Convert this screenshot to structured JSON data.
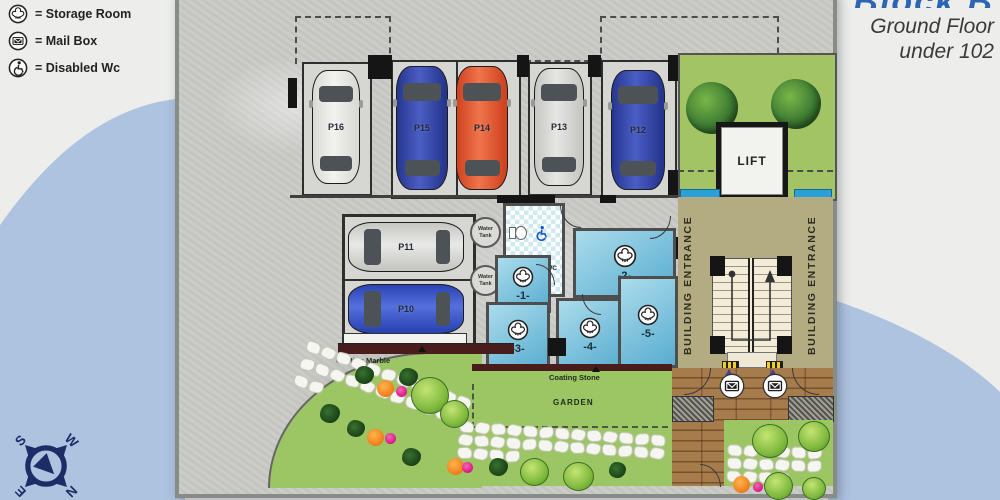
{
  "legend": {
    "items": [
      {
        "icon": "storage-room-icon",
        "label": "= Storage Room"
      },
      {
        "icon": "mailbox-icon",
        "label": "= Mail Box"
      },
      {
        "icon": "disabled-wc-icon",
        "label": "= Disabled Wc"
      }
    ]
  },
  "title": {
    "block_partial": "Block B",
    "line1": "Ground Floor",
    "line2": "under 102"
  },
  "compass": {
    "north": "N",
    "south": "S",
    "east": "E",
    "west": "W"
  },
  "plan": {
    "parking_top": [
      {
        "id": "P16",
        "color": "#e9eae7"
      },
      {
        "id": "P15",
        "color": "#2f41a8"
      },
      {
        "id": "P14",
        "color": "#e4502a"
      },
      {
        "id": "P13",
        "color": "#d7d8d5"
      },
      {
        "id": "P12",
        "color": "#2f41a8"
      }
    ],
    "parking_side": [
      {
        "id": "P11",
        "color": "#d7d8d5"
      },
      {
        "id": "P10",
        "color": "#3653c6"
      }
    ],
    "water_tanks": [
      {
        "label": "Water Tank"
      },
      {
        "label": "Water Tank"
      }
    ],
    "storage_rooms": [
      {
        "id": "-1-"
      },
      {
        "id": "-2-"
      },
      {
        "id": "-3-"
      },
      {
        "id": "-4-"
      },
      {
        "id": "-5-"
      }
    ],
    "disabled_wc_label": "DISABLED WC",
    "lift_label": "LIFT",
    "entrance_left_label": "BUILDING ENTRANCE",
    "entrance_right_label": "BUILDING ENTRANCE",
    "garden": {
      "coating_marble": "Coating Marble",
      "coating_stone": "Coating Stone",
      "garden_label": "GARDEN"
    }
  },
  "colors": {
    "background_blue": "#aec3e0",
    "sheet_concrete": "#c9cac6",
    "courtyard_green": "#a3c464",
    "garden_green": "#9cc564",
    "entrance_tan": "#b3ab82",
    "storage_room_blue": "#79c3dd",
    "wood_deck": "#a67c4c",
    "car_blue": "#2f41a8",
    "car_orange": "#e4502a",
    "car_silver": "#d7d8d5",
    "car_white": "#e9eae7",
    "compass_navy": "#1d2b66",
    "skylight_cyan": "#2a9fd8",
    "marble_maroon": "#4a1d1d",
    "title_blue": "#2d64b4"
  }
}
